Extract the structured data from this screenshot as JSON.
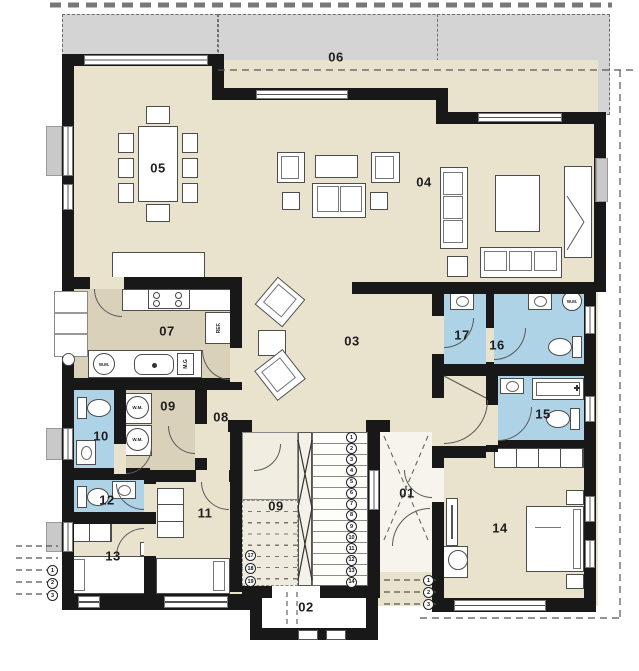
{
  "colors": {
    "wall": "#181818",
    "floor_main": "#e9e3cd",
    "floor_kitchen": "#d9d1ba",
    "floor_bath": "#aed3e6",
    "terrace": "#d4d4d4",
    "furniture_outline": "#4d4d4d"
  },
  "room_labels": {
    "r01": "01",
    "r02": "02",
    "r03": "03",
    "r04": "04",
    "r05": "05",
    "r06": "06",
    "r07": "07",
    "r08": "08",
    "r09": "09",
    "r09_stair": "09",
    "r10": "10",
    "r11": "11",
    "r12": "12",
    "r13": "13",
    "r14": "14",
    "r15": "15",
    "r16": "16",
    "r17": "17"
  },
  "appliance_labels": {
    "washing_machine": "W.M.",
    "kitchen_unit": "M.G",
    "refrigerator": "REF."
  },
  "stair_steps": {
    "main_flight": [
      "1",
      "2",
      "3",
      "4",
      "5",
      "6",
      "7",
      "8",
      "9",
      "10",
      "11",
      "12",
      "13",
      "14"
    ],
    "upper_flight": [
      "17",
      "18",
      "19"
    ],
    "entry_steps": [
      "1",
      "2",
      "3"
    ],
    "garden_steps": [
      "1",
      "2",
      "3"
    ]
  }
}
